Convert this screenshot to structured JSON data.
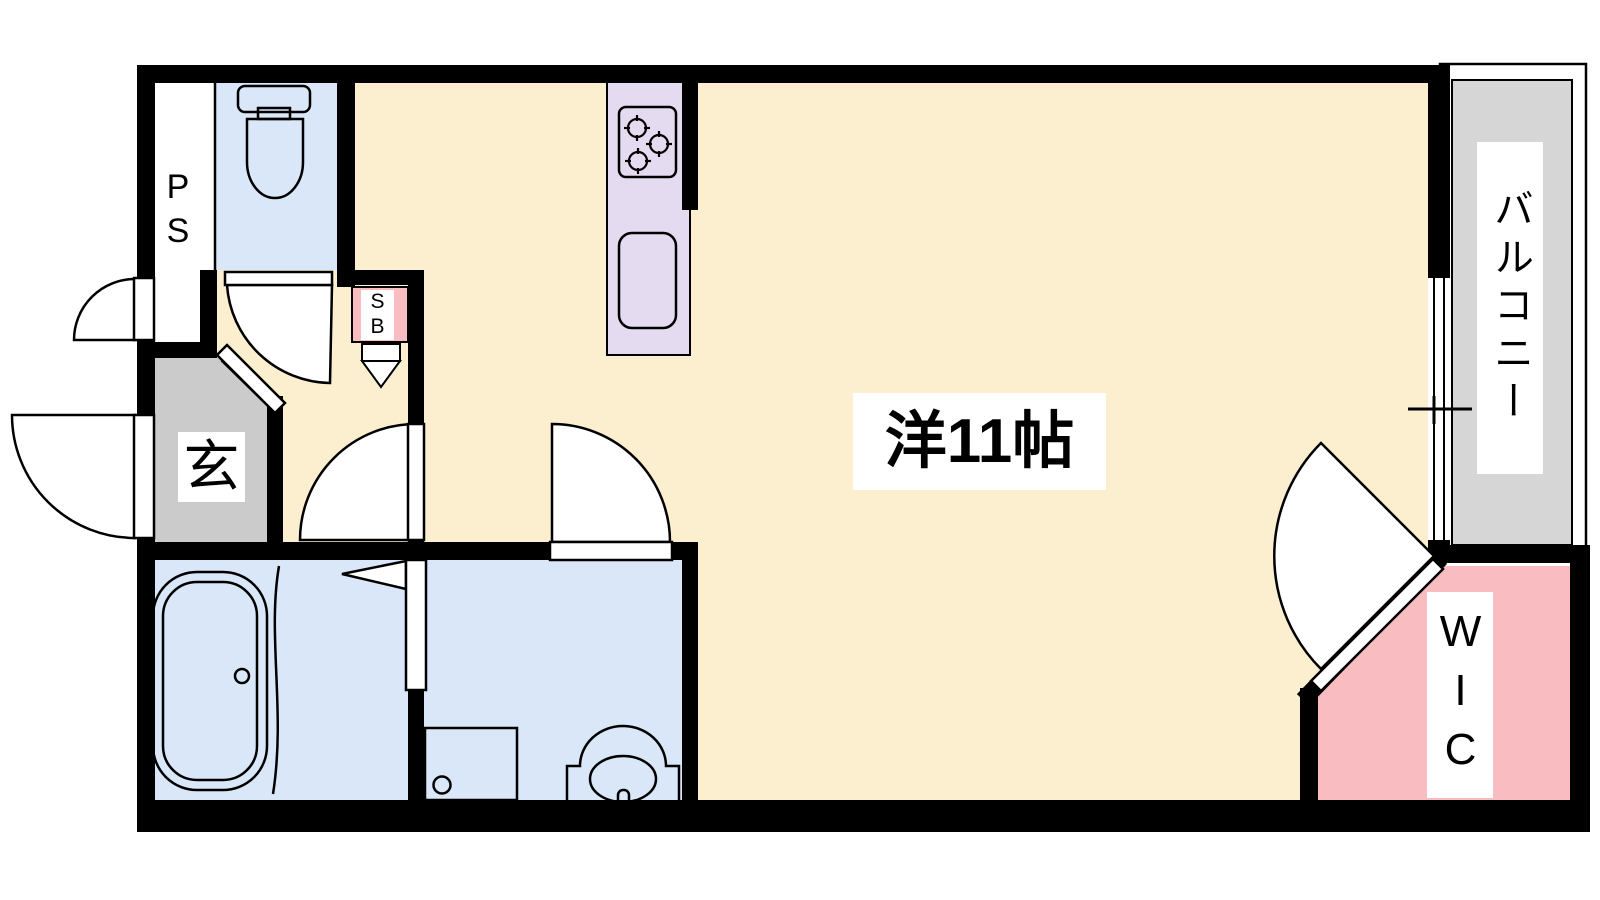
{
  "floorplan": {
    "type": "japanese-apartment-floor-plan",
    "labels": {
      "pipe_space": "PS",
      "entrance": "玄",
      "shoe_box": "SB",
      "main_room": "洋11帖",
      "balcony": "バルコニー",
      "walk_in_closet": "WIC"
    },
    "rooms": [
      {
        "name": "main-room",
        "label": "洋11帖",
        "color": "#FCEFD0"
      },
      {
        "name": "toilet",
        "label": "",
        "color": "#D9E7F8"
      },
      {
        "name": "bathroom",
        "label": "",
        "color": "#D9E7F8"
      },
      {
        "name": "washroom",
        "label": "",
        "color": "#D9E7F8"
      },
      {
        "name": "kitchen-counter",
        "label": "",
        "color": "#E5DBF0"
      },
      {
        "name": "entrance-genkan",
        "label": "玄",
        "color": "#CBCBCB"
      },
      {
        "name": "walk-in-closet",
        "label": "WIC",
        "color": "#F9BCC0"
      },
      {
        "name": "balcony",
        "label": "バルコニー",
        "color": "#D6D6D6"
      },
      {
        "name": "pipe-space",
        "label": "PS",
        "color": "#FFFFFF"
      },
      {
        "name": "shoe-box",
        "label": "SB",
        "color": "#F9BCC0"
      }
    ],
    "colors": {
      "wall": "#000000",
      "floor_main": "#FCEFD0",
      "wet_rooms": "#D9E7F8",
      "kitchen": "#E5DBF0",
      "wic": "#F9BCC0",
      "genkan": "#CBCBCB",
      "balcony": "#D6D6D6",
      "label_bg": "#FFFFFF"
    }
  }
}
